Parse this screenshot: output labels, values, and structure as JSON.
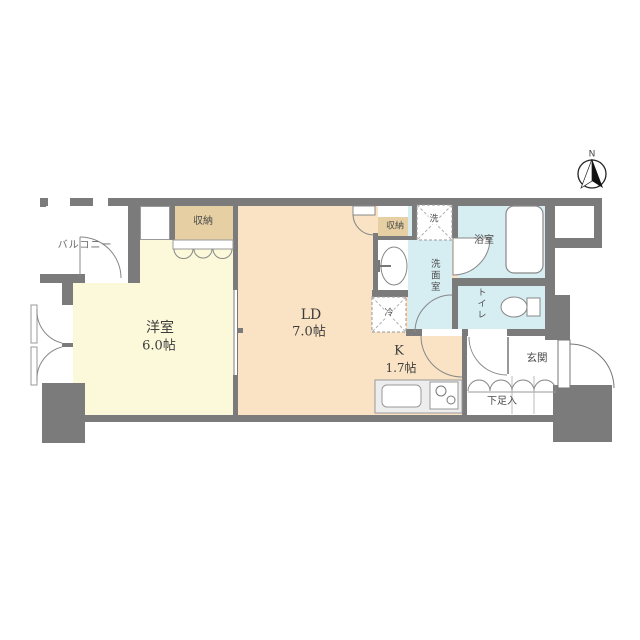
{
  "title": "1LDK apartment floor plan",
  "colors": {
    "wall": "#7b7b7b",
    "western": "#fcf9da",
    "living": "#f9e3c4",
    "closet": "#e6cfa2",
    "wet": "#d6edf2",
    "counter": "#ededed"
  },
  "compass": {
    "north_label": "N"
  },
  "rooms": {
    "balcony": {
      "name": "バルコニー"
    },
    "western": {
      "name": "洋室",
      "size": "6.0帖"
    },
    "living": {
      "name": "LD",
      "size": "7.0帖"
    },
    "kitchen": {
      "name": "K",
      "size": "1.7帖"
    },
    "closet_west": {
      "name": "収納"
    },
    "closet_ld": {
      "name": "収納"
    },
    "washroom": {
      "name": "洗面室"
    },
    "bathroom": {
      "name": "浴室"
    },
    "toilet": {
      "name": "トイレ"
    },
    "entrance": {
      "name": "玄関"
    },
    "shoe_box": {
      "name": "下足入"
    },
    "washer": {
      "name": "洗"
    },
    "fridge": {
      "name": "冷"
    }
  }
}
